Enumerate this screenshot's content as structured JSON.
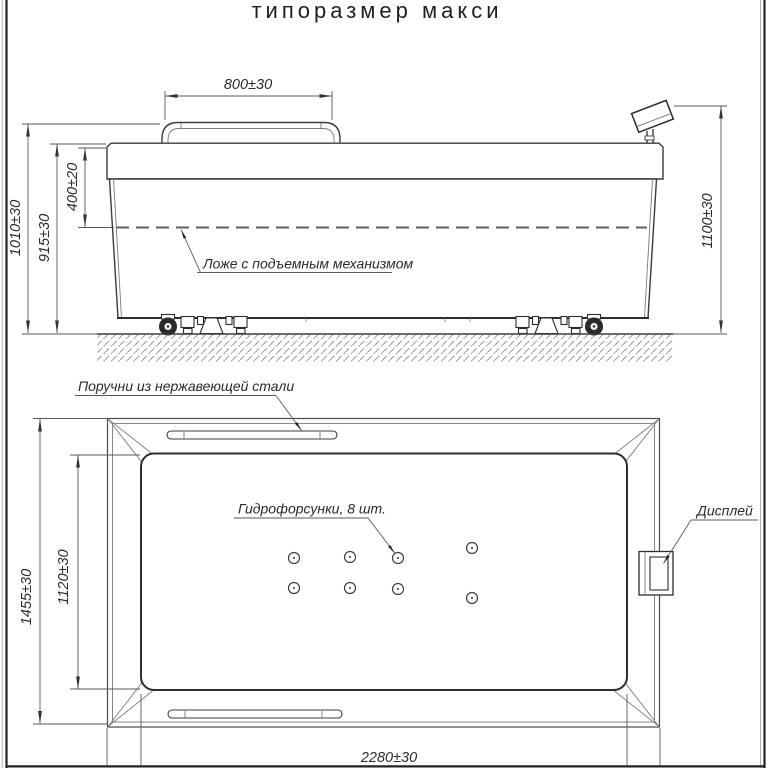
{
  "title": "типоразмер макси",
  "colors": {
    "background": "#ffffff",
    "line_dark": "#2c2c2c",
    "line_light": "#7b7b7b",
    "text": "#2b2b2b"
  },
  "elevation_view": {
    "dims": {
      "handrail_width": "800±30",
      "overall_height": "1010±30",
      "rim_height": "915±30",
      "bed_depth": "400±20",
      "display_height": "1100±30"
    },
    "labels": {
      "lifting_bed": "Ложе с подъемным механизмом"
    }
  },
  "plan_view": {
    "dims": {
      "overall_width": "1455±30",
      "basin_width": "1120±30",
      "overall_length": "2280±30"
    },
    "labels": {
      "handrails": "Поручни из нержавеющей стали",
      "jets": "Гидрофорсунки, 8 шт.",
      "display": "Дисплей"
    },
    "jet_count": 8
  }
}
